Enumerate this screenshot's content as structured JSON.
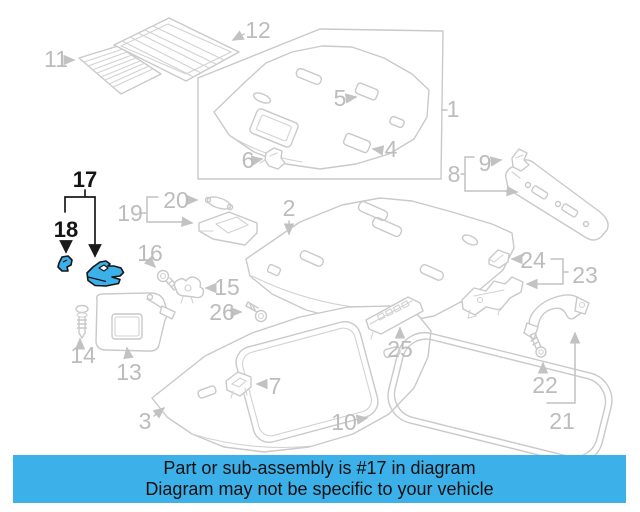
{
  "banner": {
    "line1": "Part or sub-assembly is #17 in diagram",
    "line2": "Diagram may not be specific to your vehicle",
    "background_color": "#3cb0e9",
    "text_color": "#101010"
  },
  "highlight": {
    "part_number": "17",
    "sub_part_number": "18",
    "fill_color": "#3cb0e9",
    "outline_color": "#161616"
  },
  "diagram": {
    "line_color": "#c9c9c9",
    "label_color": "#bcbcbc",
    "background_color": "#ffffff",
    "callouts": [
      {
        "label": "1",
        "highlighted": false
      },
      {
        "label": "2",
        "highlighted": false
      },
      {
        "label": "3",
        "highlighted": false
      },
      {
        "label": "4",
        "highlighted": false
      },
      {
        "label": "5",
        "highlighted": false
      },
      {
        "label": "6",
        "highlighted": false
      },
      {
        "label": "7",
        "highlighted": false
      },
      {
        "label": "8",
        "highlighted": false
      },
      {
        "label": "9",
        "highlighted": false
      },
      {
        "label": "10",
        "highlighted": false
      },
      {
        "label": "11",
        "highlighted": false
      },
      {
        "label": "12",
        "highlighted": false
      },
      {
        "label": "13",
        "highlighted": false
      },
      {
        "label": "14",
        "highlighted": false
      },
      {
        "label": "15",
        "highlighted": false
      },
      {
        "label": "16",
        "highlighted": false
      },
      {
        "label": "17",
        "highlighted": true
      },
      {
        "label": "18",
        "highlighted": true
      },
      {
        "label": "19",
        "highlighted": false
      },
      {
        "label": "20",
        "highlighted": false
      },
      {
        "label": "21",
        "highlighted": false
      },
      {
        "label": "22",
        "highlighted": false
      },
      {
        "label": "23",
        "highlighted": false
      },
      {
        "label": "24",
        "highlighted": false
      },
      {
        "label": "25",
        "highlighted": false
      },
      {
        "label": "26",
        "highlighted": false
      }
    ]
  }
}
